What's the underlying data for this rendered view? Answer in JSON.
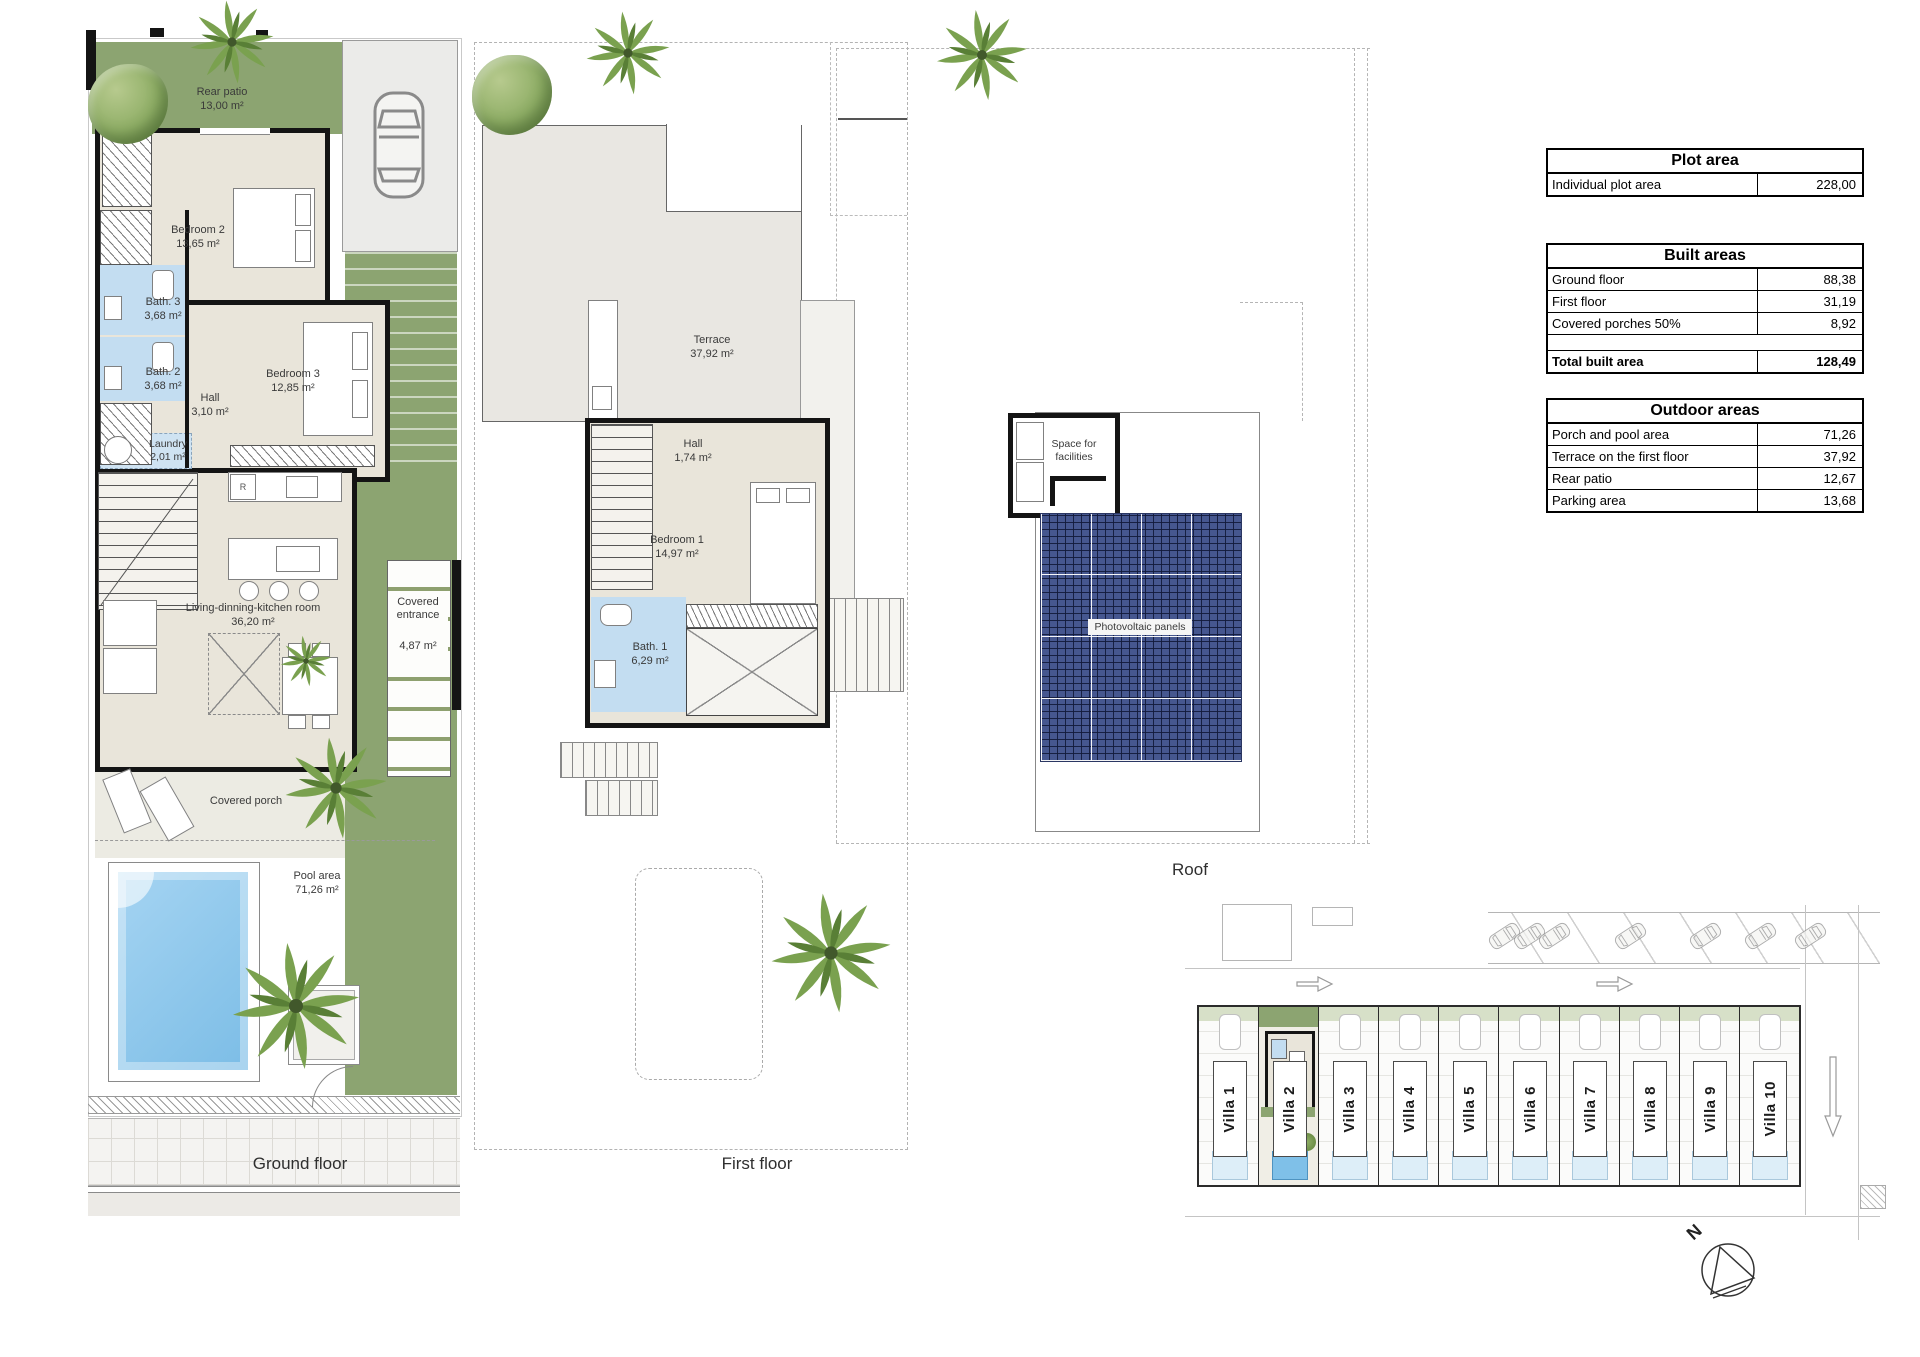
{
  "plans": {
    "ground_floor": {
      "title": "Ground floor",
      "rooms": {
        "rear_patio": {
          "name": "Rear patio",
          "area": "13,00 m²"
        },
        "bedroom2": {
          "name": "Bedroom 2",
          "area": "13,65 m²"
        },
        "bath3": {
          "name": "Bath. 3",
          "area": "3,68 m²"
        },
        "bath2": {
          "name": "Bath. 2",
          "area": "3,68 m²"
        },
        "hall": {
          "name": "Hall",
          "area": "3,10 m²"
        },
        "bedroom3": {
          "name": "Bedroom 3",
          "area": "12,85 m²"
        },
        "laundry": {
          "name": "Laundry",
          "area": "2,01 m²"
        },
        "living": {
          "name": "Living-dinning-kitchen room",
          "area": "36,20 m²"
        },
        "covered_entrance": {
          "name": "Covered entrance",
          "area": "4,87 m²"
        },
        "covered_porch": {
          "name": "Covered porch"
        },
        "pool_area": {
          "name": "Pool area",
          "area": "71,26 m²"
        }
      },
      "labels": {
        "fridge": "R"
      }
    },
    "first_floor": {
      "title": "First floor",
      "rooms": {
        "terrace": {
          "name": "Terrace",
          "area": "37,92 m²"
        },
        "hall": {
          "name": "Hall",
          "area": "1,74 m²"
        },
        "bedroom1": {
          "name": "Bedroom 1",
          "area": "14,97 m²"
        },
        "bath1": {
          "name": "Bath. 1",
          "area": "6,29 m²"
        }
      }
    },
    "roof": {
      "title": "Roof",
      "labels": {
        "facilities": "Space for facilities",
        "pv": "Photovoltaic panels"
      }
    }
  },
  "tables": {
    "plot_area": {
      "title": "Plot area",
      "rows": [
        {
          "label": "Individual plot area",
          "value": "228,00"
        }
      ]
    },
    "built_areas": {
      "title": "Built areas",
      "rows": [
        {
          "label": "Ground floor",
          "value": "88,38"
        },
        {
          "label": "First floor",
          "value": "31,19"
        },
        {
          "label": "Covered porches 50%",
          "value": "8,92"
        }
      ],
      "total": {
        "label": "Total built area",
        "value": "128,49"
      }
    },
    "outdoor_areas": {
      "title": "Outdoor areas",
      "rows": [
        {
          "label": "Porch and pool area",
          "value": "71,26"
        },
        {
          "label": "Terrace on the first floor",
          "value": "37,92"
        },
        {
          "label": "Rear patio",
          "value": "12,67"
        },
        {
          "label": "Parking area",
          "value": "13,68"
        }
      ]
    }
  },
  "site_plan": {
    "villas": [
      "Villa 1",
      "Villa 2",
      "Villa 3",
      "Villa 4",
      "Villa 5",
      "Villa 6",
      "Villa 7",
      "Villa 8",
      "Villa 9",
      "Villa 10"
    ]
  },
  "compass": {
    "north_label": "N"
  },
  "colors": {
    "garden_green": "#8ca471",
    "floor_beige": "#e9e5da",
    "bath_blue": "#c3ddf1",
    "pool_blue": "#7fc0e8",
    "pv_panel_blue": "#46578f",
    "wall_black": "#141414"
  }
}
